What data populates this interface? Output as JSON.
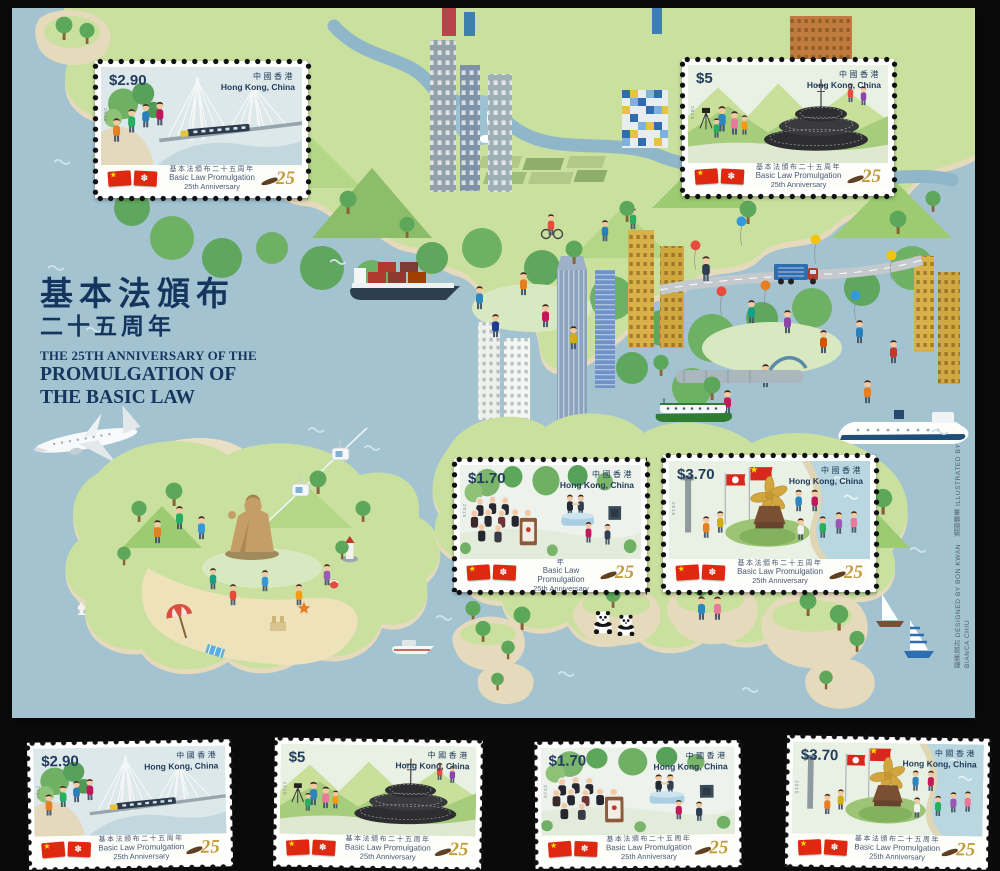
{
  "background_color": "#0a0a0a",
  "sheet": {
    "sea_color": "#a3c3d1",
    "title": {
      "zh1": "基本法頒布",
      "zh2": "二十五周年",
      "en1": "THE 25TH ANNIVERSARY OF THE",
      "en2": "PROMULGATION OF",
      "en3": "THE BASIC LAW"
    },
    "credit": "郵票設計 DESIGNED BY BON KWAN　插圖繪畫 ILLUSTRATED BY BIANCA CHIU",
    "map_features": [
      "airplane",
      "airport-runway",
      "big-buddha",
      "cable-car",
      "rail-bridge",
      "ifc-tower",
      "city-buildings",
      "mosaic-building",
      "container-ship",
      "star-ferry",
      "cruise-ship",
      "kai-tak-terminal",
      "egrets",
      "balloon-crowd",
      "truck",
      "beach-umbrella",
      "pandas",
      "sailboats",
      "yacht",
      "lighthouse",
      "islands",
      "shenzhen-river"
    ]
  },
  "stamp_common": {
    "country_zh": "中國香港",
    "country_en": "Hong Kong, China",
    "caption_zh": "基本法頒布二十五周年",
    "caption_en1": "Basic Law Promulgation",
    "caption_en2": "25th Anniversary",
    "anniversary": "25",
    "year_code": "2015",
    "flag_colors": {
      "red": "#de2910",
      "star_gold": "#ffde00",
      "bauhinia_white": "#ffffff"
    }
  },
  "sheet_stamps": [
    {
      "value": "$2.90",
      "design": "rail-bridge-with-children"
    },
    {
      "value": "$5",
      "design": "observatory-dome-with-family"
    },
    {
      "value": "$1.70",
      "design": "judiciary-ceremony"
    },
    {
      "value": "$3.70",
      "design": "golden-bauhinia-square"
    }
  ],
  "bottom_stamps": [
    {
      "value": "$2.90",
      "design": "rail-bridge-with-children"
    },
    {
      "value": "$5",
      "design": "observatory-dome-with-family"
    },
    {
      "value": "$1.70",
      "design": "judiciary-ceremony"
    },
    {
      "value": "$3.70",
      "design": "golden-bauhinia-square"
    }
  ],
  "colors": {
    "navy_text": "#14365e",
    "gold_25": "#c29b3c",
    "land_green": "#c9e09e",
    "sand": "#e6dabc"
  }
}
